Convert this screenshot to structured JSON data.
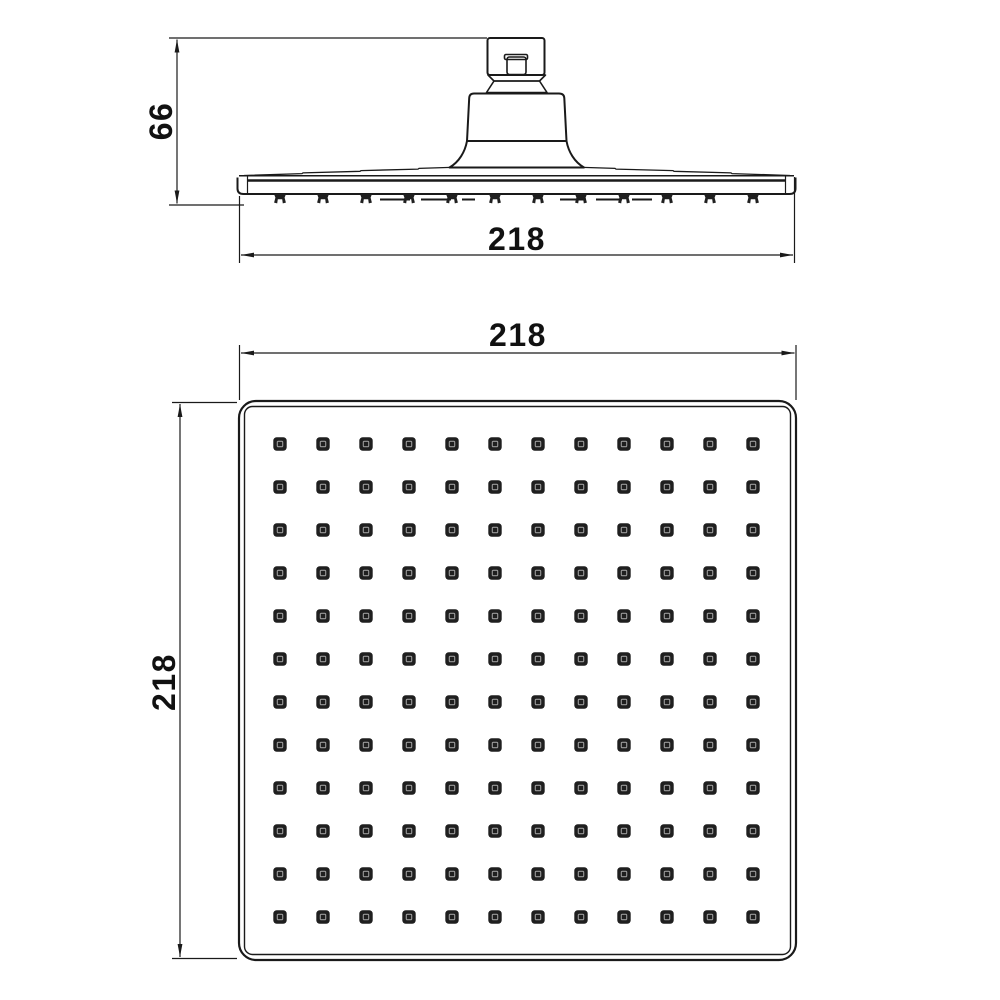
{
  "canvas": {
    "background": "#ffffff",
    "line_color": "#1a1a1a",
    "nozzle_fill": "#1f1f1f",
    "nozzle_inner_stroke": "#9a9a9a"
  },
  "drawing": {
    "subject": "square-rain-shower-head-technical-drawing",
    "views": {
      "side": {
        "dim_height": {
          "value": "66"
        },
        "dim_width": {
          "value": "218"
        },
        "nozzle_count": 12
      },
      "face": {
        "dim_width": {
          "value": "218"
        },
        "dim_height": {
          "value": "218"
        },
        "grid": {
          "rows": 12,
          "cols": 12,
          "col_start": 280,
          "row_start": 444,
          "spacing": 43
        }
      }
    }
  }
}
